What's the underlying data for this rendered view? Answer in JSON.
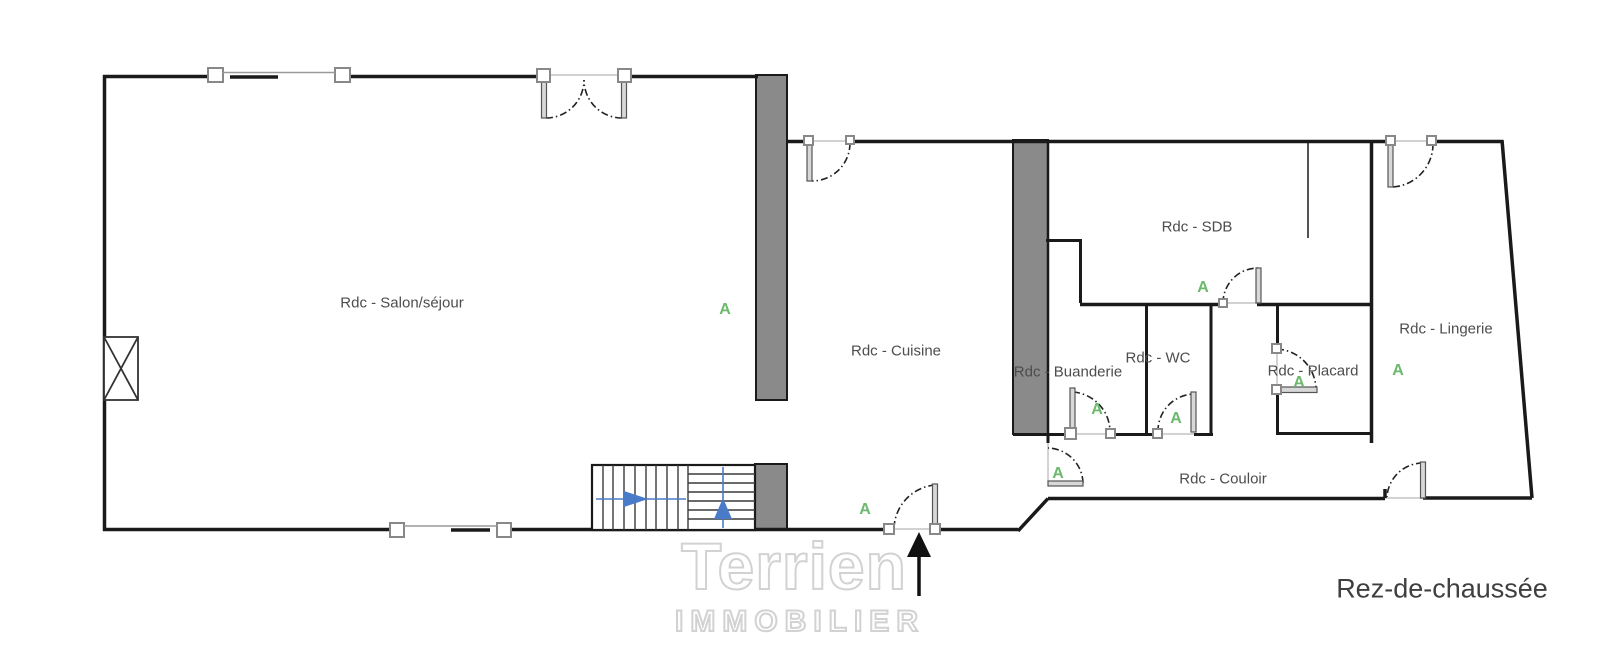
{
  "floorplan": {
    "floor_label": "Rez-de-chaussée",
    "rooms": [
      {
        "label": "Rdc - Salon/séjour"
      },
      {
        "label": "Rdc - Cuisine"
      },
      {
        "label": "Rdc - SDB"
      },
      {
        "label": "Rdc - Buanderie"
      },
      {
        "label": "Rdc - WC"
      },
      {
        "label": "Rdc - Placard"
      },
      {
        "label": "Rdc - Lingerie"
      },
      {
        "label": "Rdc - Couloir"
      }
    ],
    "section_markers": [
      "A",
      "A",
      "A",
      "A",
      "A",
      "A",
      "A",
      "A"
    ],
    "marker_color": "#6cb86c",
    "wall_color": "#1a1a1a",
    "bearing_wall_color": "#8a8a8a",
    "stair_arrow_color": "#4a7bc8",
    "watermark": {
      "line1": "Terrien",
      "line2": "IMMOBILIER"
    }
  }
}
